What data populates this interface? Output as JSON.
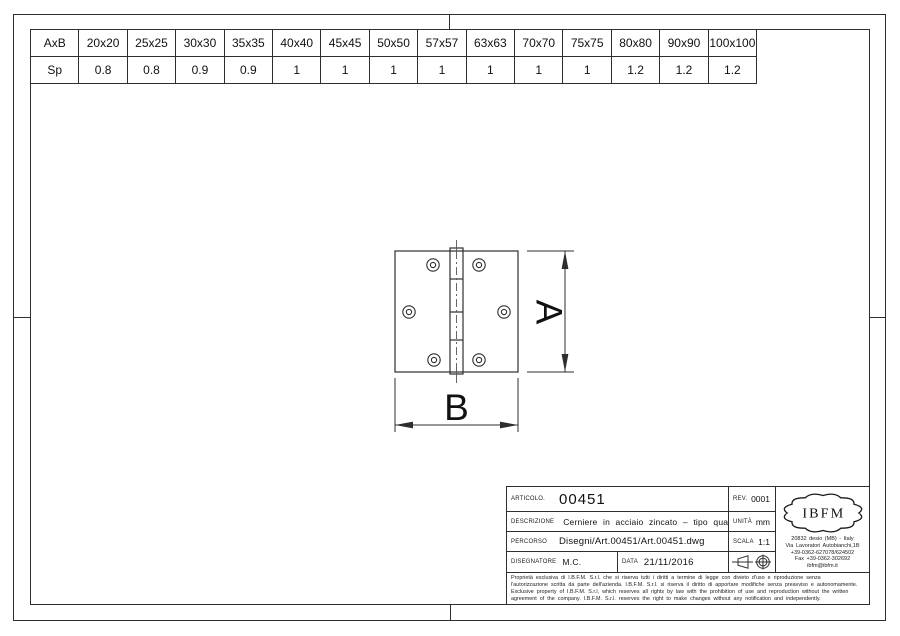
{
  "colors": {
    "line": "#2e2e2e",
    "text": "#111111",
    "background": "#ffffff"
  },
  "size_table": {
    "header_row": [
      "AxB",
      "20x20",
      "25x25",
      "30x30",
      "35x35",
      "40x40",
      "45x45",
      "50x50",
      "57x57",
      "63x63",
      "70x70",
      "75x75",
      "80x80",
      "90x90",
      "100x100"
    ],
    "sp_row": [
      "Sp",
      "0.8",
      "0.8",
      "0.9",
      "0.9",
      "1",
      "1",
      "1",
      "1",
      "1",
      "1",
      "1",
      "1.2",
      "1.2",
      "1.2"
    ]
  },
  "drawing": {
    "height_dim_label": "A",
    "width_dim_label": "B"
  },
  "title_block": {
    "articolo": {
      "label": "ARTICOLO.",
      "value": "00451"
    },
    "rev": {
      "label": "REV.",
      "value": "0001"
    },
    "descrizione": {
      "label": "DESCRIZIONE",
      "value": "Cerniere in acciaio zincato – tipo quadro"
    },
    "unita": {
      "label": "UNITÀ",
      "value": "mm"
    },
    "percorso": {
      "label": "PERCORSO",
      "value": "Disegni/Art.00451/Art.00451.dwg"
    },
    "scala": {
      "label": "SCALA",
      "value": "1:1"
    },
    "disegnatore": {
      "label": "DISEGNATORE",
      "value": "M.C."
    },
    "data": {
      "label": "DATA",
      "value": "21/11/2016"
    },
    "legal_lines": [
      "Proprietà esclusiva di I.B.F.M. S.r.l. che si riserva tutti i diritti a termine di legge con divieto d'uso e riproduzione senza",
      "l'autorizzazione scritta da parte dell'azienda. I.B.F.M. S.r.l. si riserva il diritto di apportare modifiche senza preavviso e autonomamente.",
      "Exclusive property of I.B.F.M. S.r.l. which reserves all rights by law with the prohibition of use and reproduction without the written",
      "agreement of the company. I.B.F.M. S.r.l. reserves the right to make changes without any notification and independently."
    ]
  },
  "company": {
    "logo_text": "IBFM",
    "address_lines": [
      "20832 desio (MB) - Italy",
      "Via Lavoratori Autobianchi,1B",
      "+39-0362-627078/624502",
      "Fax +39-0362-302692",
      "ibfm@ibfm.it"
    ]
  }
}
